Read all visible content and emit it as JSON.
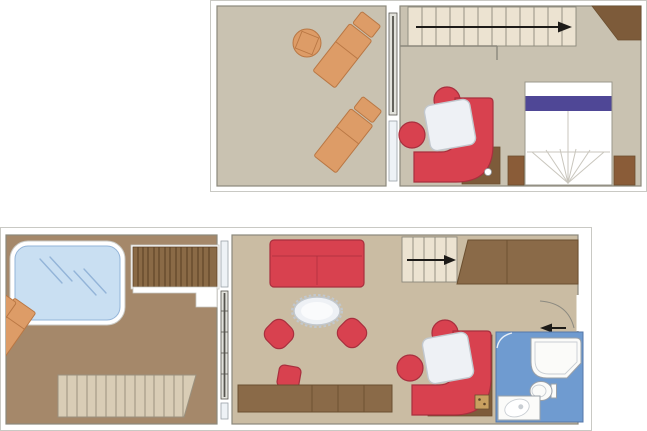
{
  "plans": {
    "upper_deck": {
      "rooms": {
        "balcony": {
          "furniture": [
            "sun-lounger",
            "sun-lounger",
            "round-drinks-table",
            "sliding-glass-door",
            "window"
          ]
        },
        "bedroom": {
          "furniture": [
            "staircase",
            "stair-direction-arrow-right",
            "angled-wardrobe",
            "double-bed",
            "bed-runner",
            "nightstand-left",
            "nightstand-right",
            "curved-banquette",
            "square-table",
            "stool",
            "stool",
            "corner-unit"
          ]
        }
      }
    },
    "lower_deck": {
      "rooms": {
        "balcony": {
          "furniture": [
            "whirlpool-tub",
            "decking-slats-upper",
            "decking-steps-lower",
            "sun-lounger",
            "sun-lounger"
          ]
        },
        "living_room": {
          "furniture": [
            "two-seat-sofa",
            "oval-coffee-table",
            "tub-chair",
            "tub-chair",
            "stool",
            "sideboard-cabinets",
            "sliding-glass-door",
            "window",
            "window"
          ]
        },
        "hallway": {
          "furniture": [
            "staircase",
            "stair-direction-arrow-right",
            "under-stair-wardrobe",
            "entry-door",
            "entry-direction-arrow-left"
          ]
        },
        "dining_nook": {
          "furniture": [
            "curved-banquette",
            "square-table",
            "stool",
            "stool",
            "mini-fridge"
          ]
        },
        "bathroom": {
          "furniture": [
            "bathtub-shower",
            "toilet",
            "washbasin-vanity",
            "door-swing"
          ]
        }
      }
    }
  },
  "colors": {
    "page_bg": "#ffffff",
    "frame_border": "#c9c9c4",
    "wall_line": "#8b887c",
    "carpet_upper": "#c9c2b1",
    "carpet_lower": "#cabca3",
    "deck_brown": "#a5886a",
    "slat_deck_dark": "#8a6a46",
    "slat_line_dark": "#5d4226",
    "slat_deck_light": "#d9cdb6",
    "slat_line_light": "#9a917f",
    "wood_lounger": "#dd9c67",
    "wood_lounger_outline": "#b97744",
    "wood_dark": "#8a6a48",
    "wood_dark_outline": "#6b4f30",
    "wood_nightstand": "#8a5c38",
    "wood_corner": "#7d5b3a",
    "red_furniture": "#d8414f",
    "red_furniture_outline": "#a82f3e",
    "table_top": "#eef1f5",
    "table_outline": "#c2c8ce",
    "bed_white": "#ffffff",
    "bed_outline": "#9b988c",
    "bed_runner_indigo": "#4f4796",
    "bed_fold_line": "#c9c6bd",
    "stairs_cream": "#ece3d1",
    "stair_tread_line": "#8d897b",
    "whirlpool_water": "#c9dff2",
    "whirlpool_rim": "#ffffff",
    "water_line": "#93b4d8",
    "bathroom_floor": "#6f9bd0",
    "bathroom_floor_outline": "#5577a8",
    "fixture_white": "#fbfbf9",
    "fixture_outline": "#9aa0a8",
    "fixture_inner_line": "#c9ced3",
    "bath_swing_line": "#e8f0f8",
    "glass_pane": "#eef2f6",
    "door_fill": "#e2e2dc",
    "door_rail": "#55544e",
    "door_arc": "#8c8a80",
    "arrow_black": "#1d1b18",
    "mini_fridge": "#c9a060"
  }
}
